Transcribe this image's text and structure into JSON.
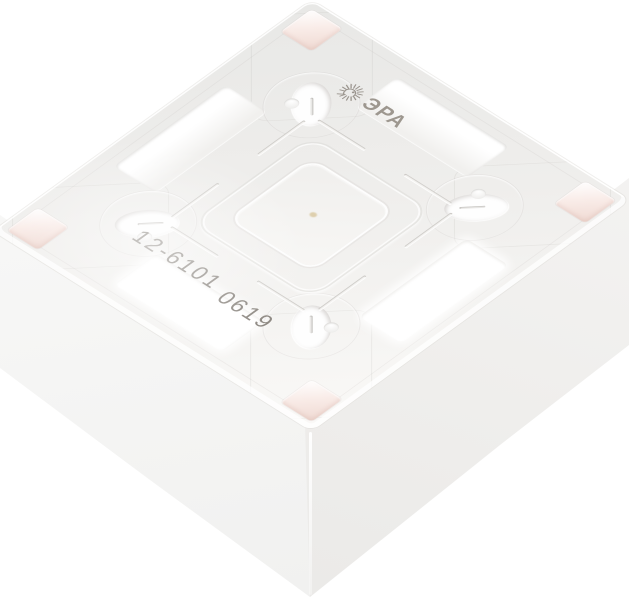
{
  "image": {
    "kind": "product photograph",
    "subject": "White plastic surface-mount wall-switch installation box, viewed from its open mounting side at an angle",
    "background_color": "#ffffff"
  },
  "markings": {
    "brand_text": "ЭРА",
    "brand_icon": "sunburst-spiral-icon",
    "model_number": "12-6101",
    "date_code": "0619",
    "ink_color": "#8d8882"
  },
  "palette": {
    "plastic_light": "#f6f5f3",
    "plastic_shaded": "#e8e8e6",
    "recess_pink": "#efd9d2",
    "groove_gray": "#dcdbd8",
    "wall_left": "#f6f6f5",
    "wall_right": "#efeeec",
    "center_speck": "#d9c79e"
  }
}
